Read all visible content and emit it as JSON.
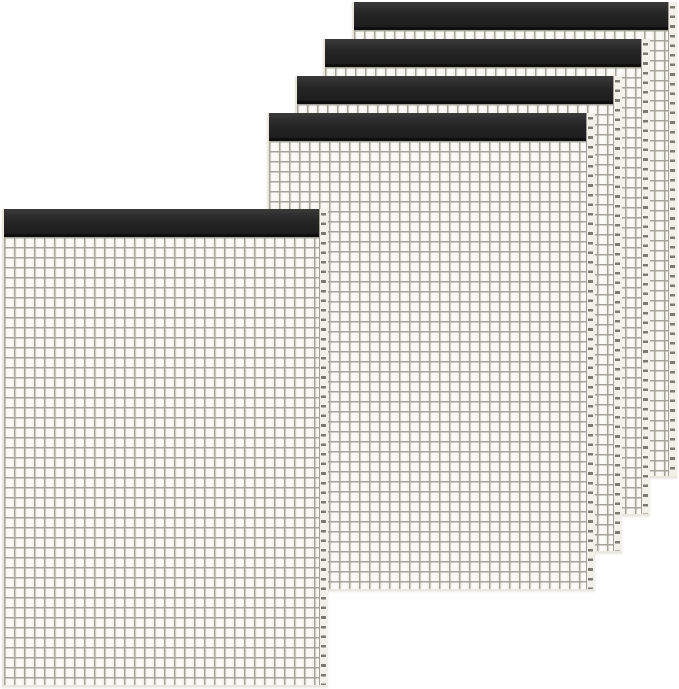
{
  "scene": {
    "description": "Product photo of five black-bound quad-ruled graph paper notepads fanned in an overlapping diagonal cascade on a white background",
    "item_count": 5,
    "text_visible": "none"
  },
  "colors": {
    "bg": "#ffffff",
    "paper": "#f5f4ec",
    "grid_line": "#a5a49a",
    "binding": "#262626",
    "binding_dark": "#0f0f0f",
    "paper_edge": "#e9e7de",
    "strip_bg": "#f2f1e9",
    "strip_border": "#a19f96",
    "dash": "#7c7b72"
  },
  "grid": {
    "cell_size_px": 10,
    "line_thickness_px": 1.6,
    "binding_height_px": 28,
    "edge_strip_width_px": 9
  },
  "canvas": {
    "width": 679,
    "height": 689
  },
  "pads": [
    {
      "name": "notepad-back-1",
      "x": 352,
      "y": 2,
      "w": 325,
      "h": 476,
      "z": 1
    },
    {
      "name": "notepad-back-2",
      "x": 323,
      "y": 39,
      "w": 327,
      "h": 477,
      "z": 2
    },
    {
      "name": "notepad-back-3",
      "x": 295,
      "y": 76,
      "w": 327,
      "h": 477,
      "z": 3
    },
    {
      "name": "notepad-back-4",
      "x": 267,
      "y": 113,
      "w": 328,
      "h": 478,
      "z": 4
    },
    {
      "name": "notepad-front",
      "x": 2,
      "y": 209,
      "w": 326,
      "h": 478,
      "z": 5
    }
  ]
}
